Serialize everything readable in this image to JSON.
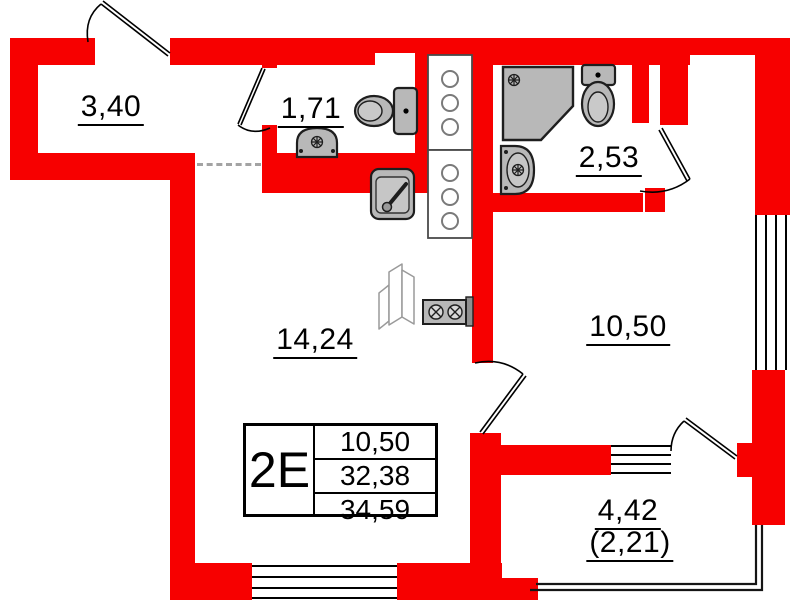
{
  "plan": {
    "labels": {
      "balcony_top": "3,40",
      "bathroom_small": "1,71",
      "bathroom_large": "2,53",
      "main_room": "14,24",
      "bedroom": "10,50",
      "balcony_bottom": "4,42",
      "balcony_bottom_reduced": "(2,21)"
    },
    "info_table": {
      "unit_type": "2Е",
      "rows": [
        "10,50",
        "32,38",
        "34,59"
      ]
    },
    "colors": {
      "wall": "#f70000",
      "fixtures": "#b8b8b8",
      "lines": "#000000"
    }
  }
}
